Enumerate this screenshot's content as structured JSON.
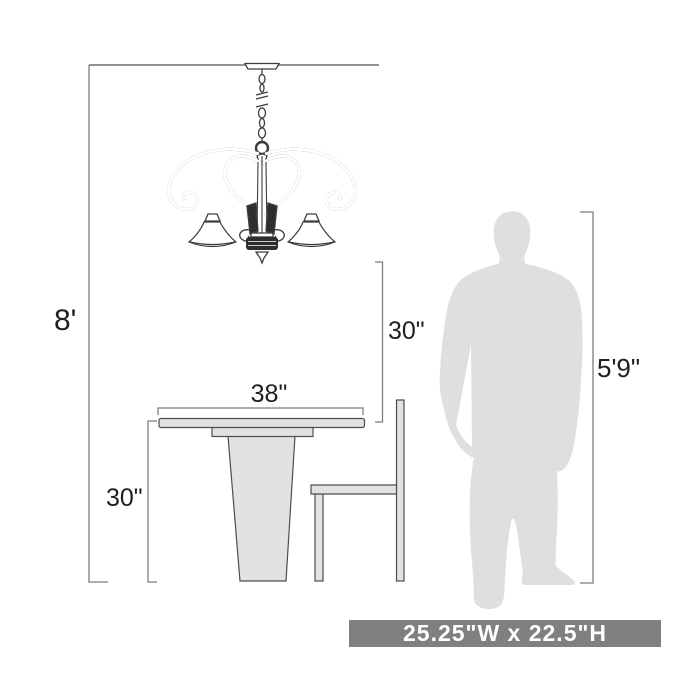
{
  "diagram": {
    "type": "product-dimension-diagram",
    "subject": "3-light chandelier over pedestal dining table with chair and human figure for scale",
    "labels": {
      "ceiling_height": "8'",
      "fixture_to_table": "30\"",
      "table_width": "38\"",
      "table_height": "30\"",
      "person_height": "5'9\""
    },
    "banner": {
      "text": "25.25\"W x 22.5\"H"
    },
    "colors": {
      "dimension_line": "#7e7e7e",
      "label_text": "#1f1f1f",
      "banner_bg": "#808080",
      "banner_text": "#ffffff",
      "furniture_fill": "#e2e2e2",
      "furniture_stroke": "#4d4d4d",
      "silhouette_fill": "#dfdfdf",
      "fixture_stroke": "#3d3d3d"
    }
  }
}
